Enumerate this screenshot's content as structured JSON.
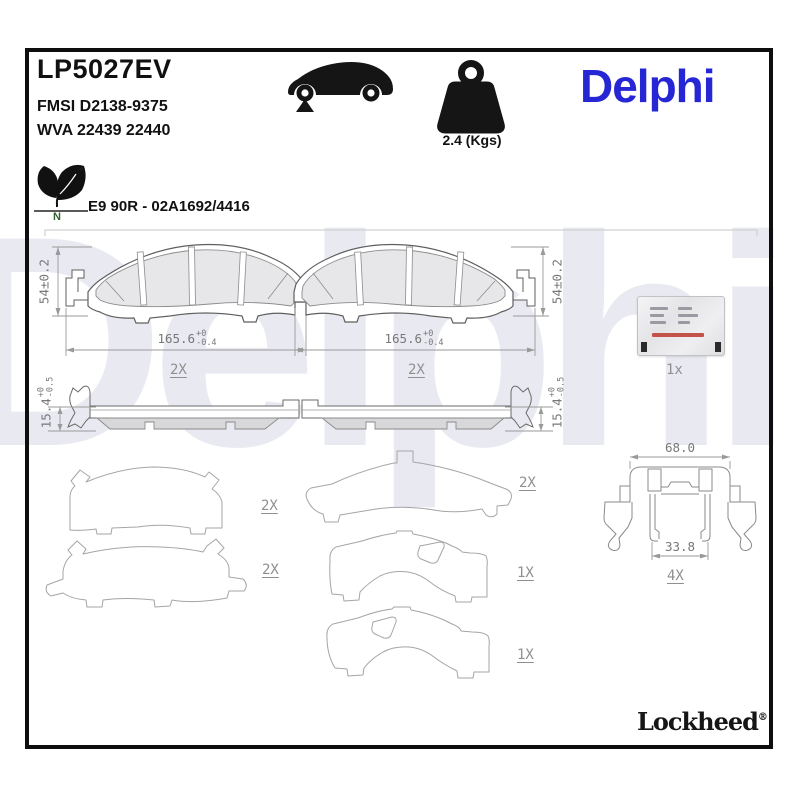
{
  "header": {
    "part_number": "LP5027EV",
    "fmsi": "FMSI D2138-9375",
    "wva": "WVA 22439 22440",
    "approval": "E9 90R - 02A1692/4416",
    "eco_letter": "N",
    "trademark": "™",
    "weight": "2.4 (Kgs)",
    "brand": "Delphi"
  },
  "watermark": "Delphi",
  "pads": {
    "left": {
      "height_dim": "54±0.2",
      "width": {
        "value": "165.6",
        "tol_plus": "+0",
        "tol_minus": "-0.4"
      },
      "qty": "2X"
    },
    "right": {
      "height_dim": "54±0.2",
      "width": {
        "value": "165.6",
        "tol_plus": "+0",
        "tol_minus": "-0.4"
      },
      "qty": "2X"
    }
  },
  "side_views": {
    "left": {
      "thickness": {
        "value": "15.4",
        "tol_plus": "+0",
        "tol_minus": "-0.5"
      }
    },
    "right": {
      "thickness": {
        "value": "15.4",
        "tol_plus": "+0",
        "tol_minus": "-0.5"
      }
    }
  },
  "accessories": {
    "grease_sachet_qty": "1x"
  },
  "shim_qtys": [
    "2X",
    "2X",
    "2X",
    "1X",
    "1X"
  ],
  "clip": {
    "width_top": "68.0",
    "width_bottom": "33.8",
    "qty": "4X"
  },
  "footer": {
    "brand": "Lockheed",
    "reg": "®"
  },
  "colors": {
    "brand_blue": "#2626D5",
    "line_gray": "#8a8a8a",
    "dim_text": "#787878",
    "watermark": "#e9eaf1"
  }
}
